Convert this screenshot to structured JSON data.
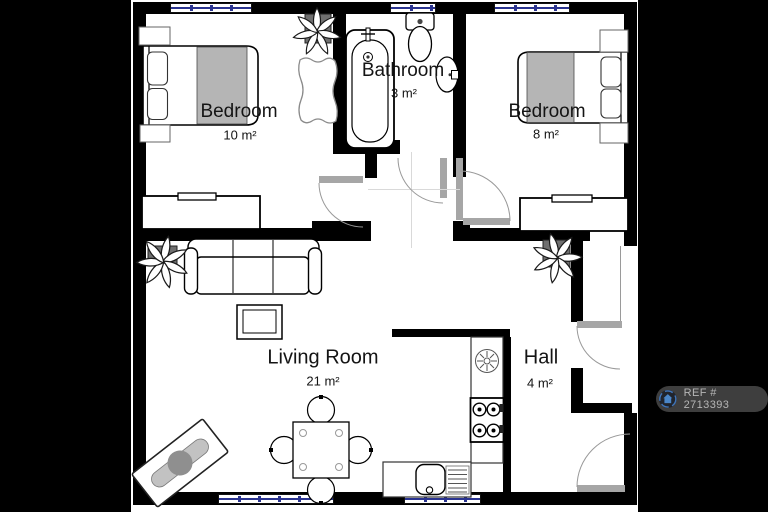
{
  "plan": {
    "rooms": [
      {
        "name": "Bedroom",
        "area": "10 m²"
      },
      {
        "name": "Bathroom",
        "area": "3 m²"
      },
      {
        "name": "Bedroom",
        "area": "8 m²"
      },
      {
        "name": "Living Room",
        "area": "21 m²"
      },
      {
        "name": "Hall",
        "area": "4 m²"
      }
    ],
    "furniture": [
      "double-bed",
      "double-bed",
      "nightstand",
      "dresser",
      "dresser",
      "rug",
      "rug",
      "bathtub",
      "toilet",
      "wash-basin",
      "sofa",
      "coffee-table",
      "dining-table",
      "chair",
      "plant",
      "plant",
      "plant",
      "kitchen-counter",
      "cooker-hood",
      "stove",
      "kitchen-sink"
    ],
    "colors": {
      "wall": "#000000",
      "floor": "#ffffff",
      "background": "#000000",
      "window_glazing": "#2a3390",
      "door_threshold": "#a6a6a6",
      "blanket": "#b5b5b5"
    }
  },
  "badge": {
    "ref": "REF # 2713393"
  }
}
